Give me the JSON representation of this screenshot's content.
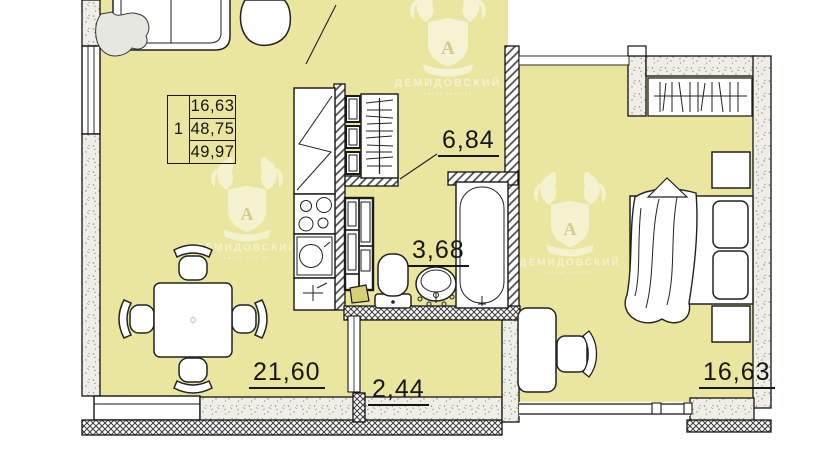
{
  "stamp": {
    "room_count": "1",
    "values": [
      "16,63",
      "48,75",
      "49,97"
    ]
  },
  "rooms": [
    {
      "name": "hallway",
      "area": "6,84"
    },
    {
      "name": "bathroom",
      "area": "3,68"
    },
    {
      "name": "living-kitchen",
      "area": "21,60"
    },
    {
      "name": "balcony",
      "area": "2,44"
    },
    {
      "name": "bedroom",
      "area": "16,63"
    }
  ],
  "watermark": {
    "brand": "ДЕМИДОВСКИЙ",
    "tagline": "жилой квартал",
    "monogram": "А"
  },
  "colors": {
    "floor": "#eae59f",
    "line": "#1a1a1a",
    "watermark": "#ffffff"
  }
}
